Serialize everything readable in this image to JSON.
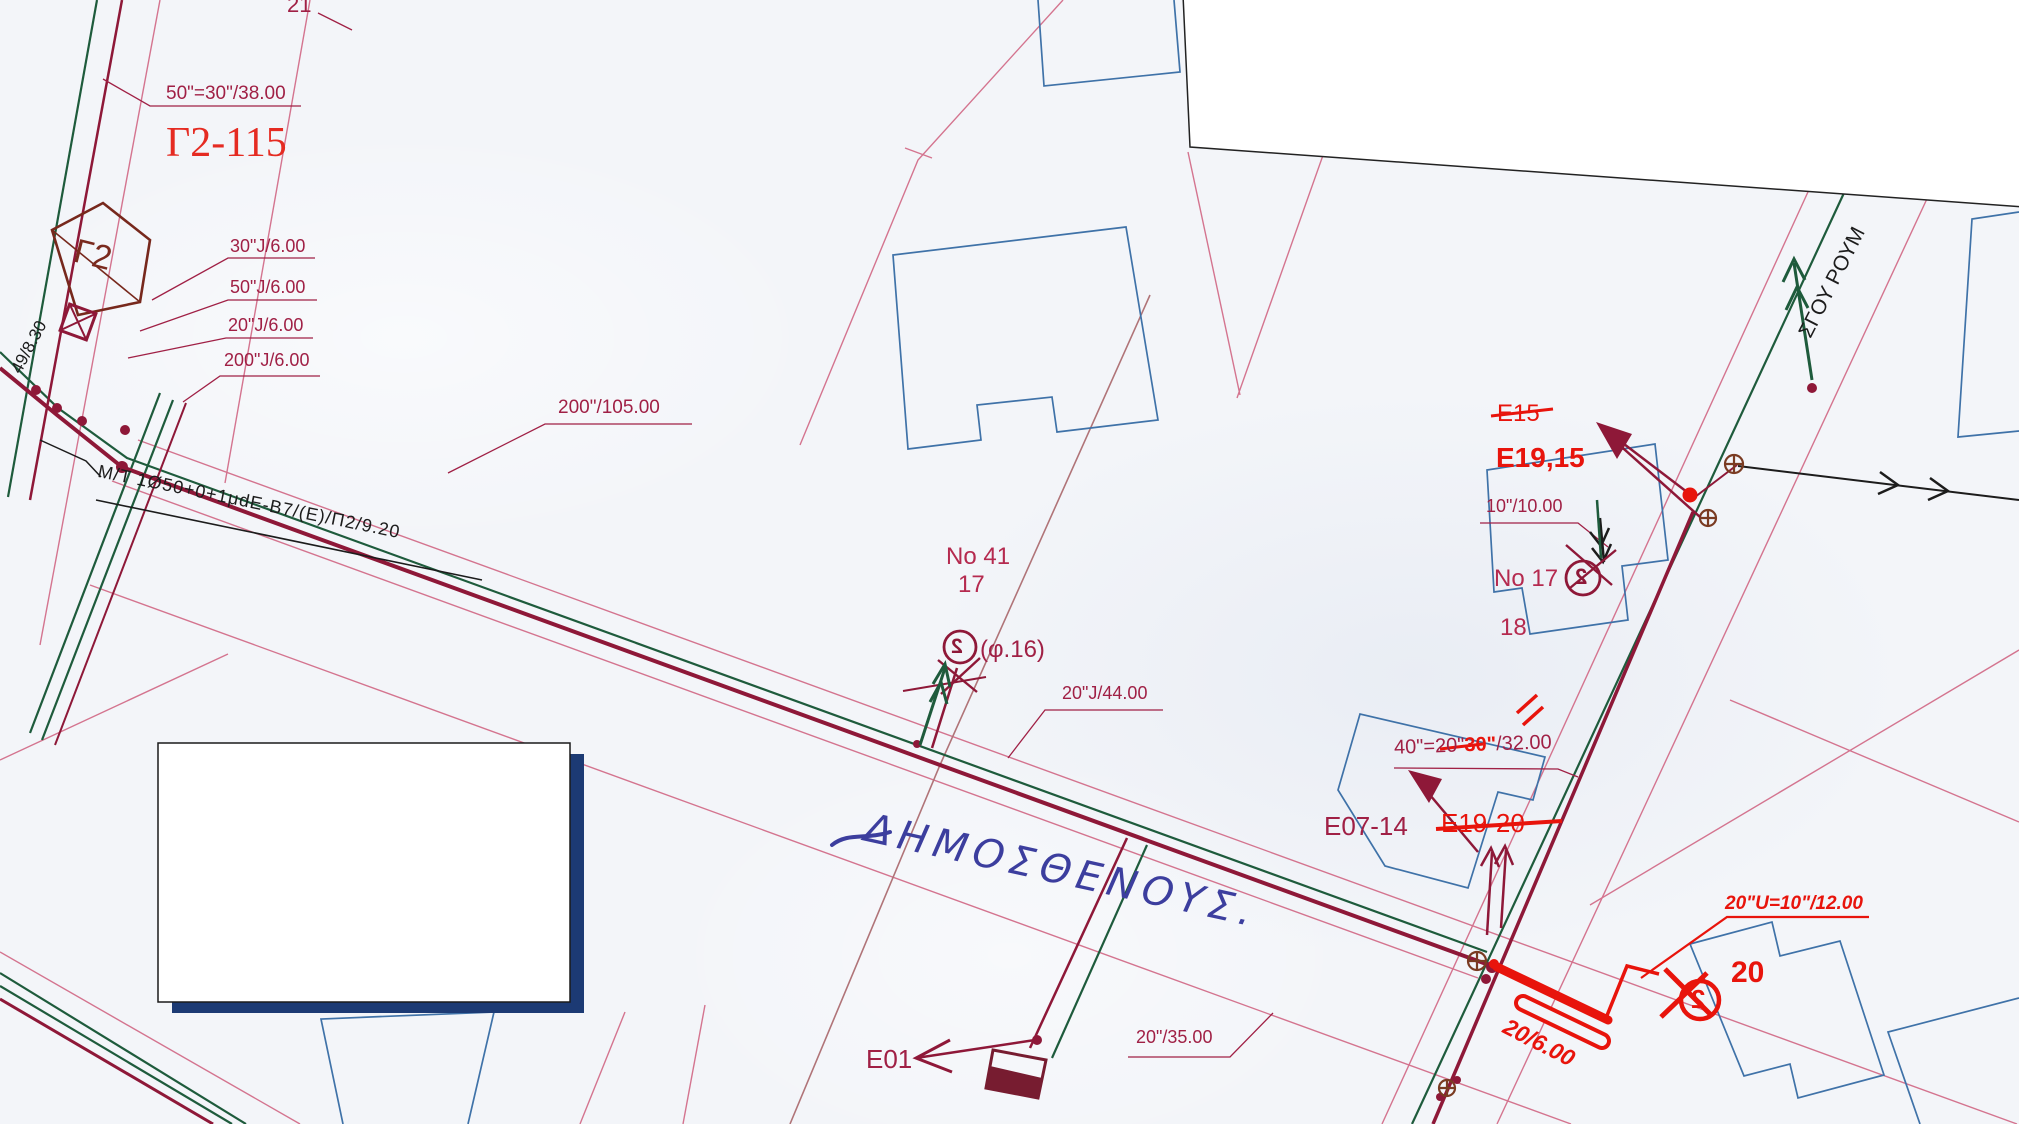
{
  "title": "Utility cable network plan (scanned)",
  "annotations": {
    "parcel_21": "21",
    "duct_50_30": "50\"=30\"/38.00",
    "cabinet_id": "Γ2-115",
    "joint_30": "30\"J/6.00",
    "joint_50": "50\"J/6.00",
    "joint_20": "20\"J/6.00",
    "joint_200": "200\"J/6.00",
    "cabinet_label": "Γ2",
    "left_measure": "49/8.30",
    "mt_cable": "M/T 1Ø50+0+1μdE-B7/(E)/Π2/9.20",
    "duct_200_105": "200\"/105.00",
    "house_no_41": "No 41",
    "parcel_17": "17",
    "dp_phi16": "(φ.16)",
    "duct_20_44": "20\"J/44.00",
    "street_name_hand": "ΔΗΜΟΣΘΕΝΟΥΣ.",
    "dp_e15_old": "E15",
    "dp_e19_15": "E19,15",
    "duct_10_10": "10\"/10.00",
    "house_no_17": "No 17",
    "parcel_18": "18",
    "duct_40_eq": "40\"=",
    "duct_40_old": "20\"",
    "duct_40_new": "30\"",
    "duct_40_len": "/32.00",
    "dp_e07_14": "E07-14",
    "dp_e19_20_old": "E19-20",
    "red_duct_note": "20\"U=10\"/12.00",
    "red_duct_len": "20/6.00",
    "red_dp_20": "20",
    "dp_e01": "E01",
    "duct_20_35": "20\"/35.00",
    "street_name_side": "ΣΓΟΥ ΡΟΥΜ",
    "dp_symbol_glyph": "2"
  },
  "colors": {
    "paper": "#f3f5f9",
    "duct_maroon": "#8e1838",
    "cad_text_dark_red": "#a02045",
    "cable_green": "#1e5b3c",
    "parcel_pink": "#d4748f",
    "building_blue": "#3f72a8",
    "parcel_brown": "#b07478",
    "markup_red": "#e8140c",
    "shadow_navy": "#1c3a74",
    "handwriting_blue": "#3c3e9e",
    "ink_black": "#1c1c1c"
  }
}
